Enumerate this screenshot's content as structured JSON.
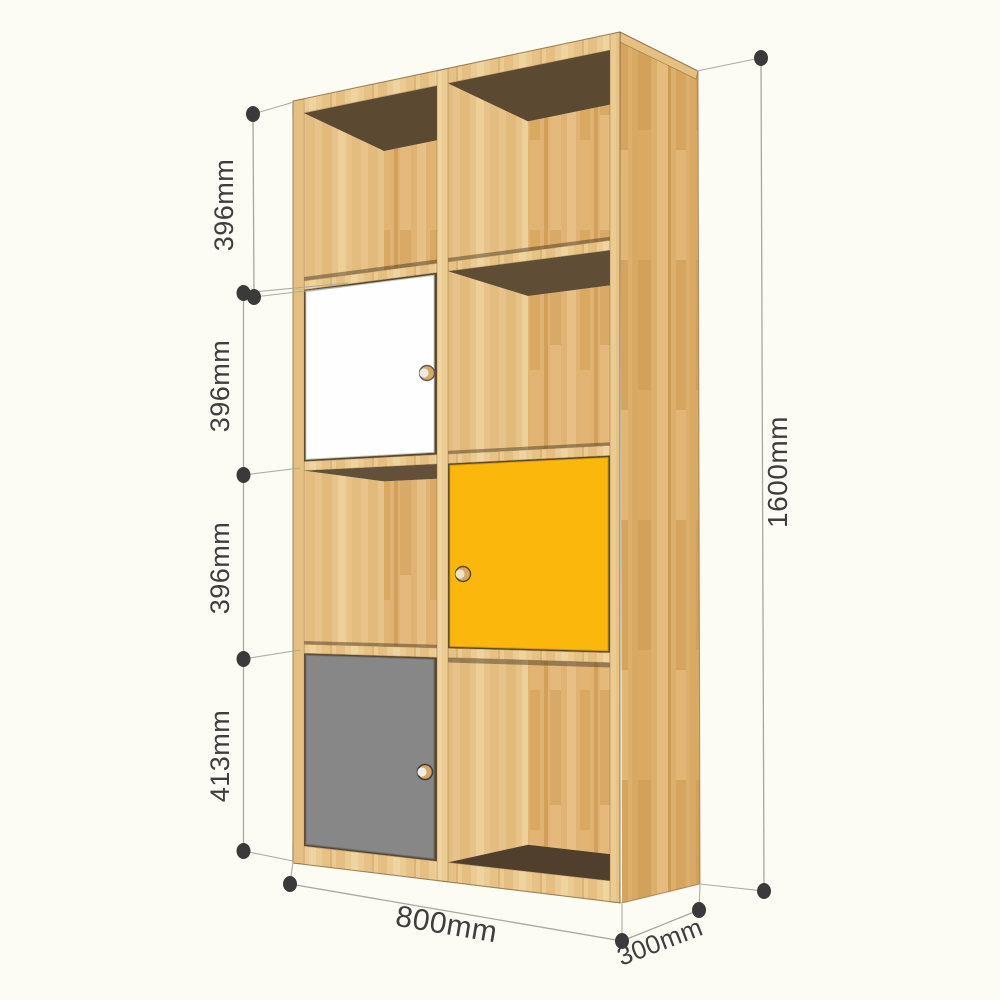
{
  "diagram": {
    "title": "bookshelf dimension diagram",
    "dimensions": {
      "section_heights": [
        {
          "label": "396mm"
        },
        {
          "label": "396mm"
        },
        {
          "label": "396mm"
        },
        {
          "label": "413mm"
        }
      ],
      "total_height": {
        "label": "1600mm"
      },
      "width": {
        "label": "800mm"
      },
      "depth": {
        "label": "300mm"
      }
    },
    "cabinet": {
      "rows": 4,
      "columns": 2,
      "doors": [
        {
          "position": "row-2-left",
          "color_name": "white",
          "color": "#FEFEFE"
        },
        {
          "position": "row-3-right",
          "color_name": "yellow",
          "color": "#FCB70D"
        },
        {
          "position": "row-4-left",
          "color_name": "gray",
          "color": "#878788"
        }
      ],
      "colors": {
        "wood_front": "#EBCB92",
        "wood_side": "#DCAF6D",
        "wood_back": "#E0B375",
        "interior_shadow": "#5C4932",
        "knob": "#D9A75F"
      }
    },
    "annotation_colors": {
      "dimension_line": "#A8A79B",
      "dimension_text": "#3E3E3E",
      "background": "#FCFCF5"
    }
  }
}
